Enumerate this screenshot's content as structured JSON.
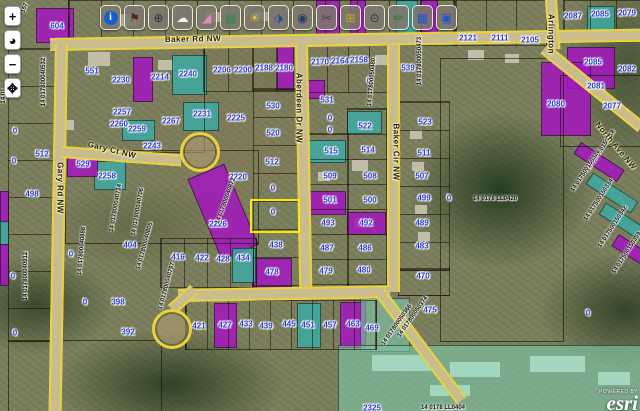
{
  "toolbar": {
    "buttons": [
      {
        "name": "info-icon",
        "glyph": "i",
        "color": "#ffffff",
        "circle": true
      },
      {
        "name": "flag-icon",
        "glyph": "⚑",
        "color": "#5a2424"
      },
      {
        "name": "zoom-in-icon",
        "glyph": "⊕",
        "color": "#333333"
      },
      {
        "name": "cloud-icon",
        "glyph": "☁",
        "color": "#f2f2f2"
      },
      {
        "name": "eraser-icon",
        "glyph": "◢",
        "color": "#e388c0"
      },
      {
        "name": "map-icon",
        "glyph": "▦",
        "color": "#2e8b57"
      },
      {
        "name": "bulb-icon",
        "glyph": "☀",
        "color": "#e8c32a"
      },
      {
        "name": "car-icon",
        "glyph": "⬗",
        "color": "#274b8f"
      },
      {
        "name": "camera-icon",
        "glyph": "◉",
        "color": "#223a66"
      },
      {
        "name": "scissors-icon",
        "glyph": "✂",
        "color": "#444444"
      },
      {
        "name": "network-icon",
        "glyph": "⊞",
        "color": "#c8a80f"
      },
      {
        "name": "search-icon",
        "glyph": "⊙",
        "color": "#333333"
      },
      {
        "name": "pencil-icon",
        "glyph": "✏",
        "color": "#2a7d2a"
      },
      {
        "name": "grid-icon",
        "glyph": "▦",
        "color": "#2255cc"
      },
      {
        "name": "save-icon",
        "glyph": "▣",
        "color": "#2255cc"
      }
    ]
  },
  "nav": [
    {
      "name": "zoom-in-button",
      "glyph": "+"
    },
    {
      "name": "globe-button",
      "glyph": "◕"
    },
    {
      "name": "zoom-out-button",
      "glyph": "−"
    },
    {
      "name": "pan-button",
      "glyph": "✥"
    }
  ],
  "attribution": {
    "powered": "POWERED BY",
    "brand": "esri"
  },
  "colors": {
    "purple": "rgba(163,22,190,.85)",
    "teal": "rgba(58,172,168,.8)",
    "teal_light": "rgba(125,200,170,.6)",
    "road_edge": "#e8d23f",
    "lot_label": "#2b3cd0",
    "selected": "#ffe800"
  },
  "labels": {
    "lots": [
      [
        "604",
        57,
        26
      ],
      [
        "2121",
        468,
        38
      ],
      [
        "2111",
        500,
        38
      ],
      [
        "2105",
        530,
        40
      ],
      [
        "2087",
        573,
        16
      ],
      [
        "2085",
        600,
        14
      ],
      [
        "2079",
        627,
        13
      ],
      [
        "551",
        92,
        71
      ],
      [
        "2230",
        121,
        80
      ],
      [
        "2214",
        160,
        77
      ],
      [
        "2240",
        188,
        74
      ],
      [
        "2206",
        222,
        70
      ],
      [
        "2200",
        243,
        70
      ],
      [
        "2188",
        264,
        68
      ],
      [
        "2180",
        284,
        68
      ],
      [
        "2170",
        320,
        62
      ],
      [
        "2164",
        340,
        61
      ],
      [
        "2158",
        359,
        60
      ],
      [
        "539",
        408,
        68
      ],
      [
        "531",
        327,
        100
      ],
      [
        "0",
        330,
        118
      ],
      [
        "0",
        330,
        130
      ],
      [
        "2257",
        122,
        112
      ],
      [
        "2260",
        119,
        124
      ],
      [
        "2259",
        137,
        129
      ],
      [
        "2267",
        171,
        121
      ],
      [
        "2231",
        202,
        114
      ],
      [
        "2225",
        236,
        118
      ],
      [
        "2243",
        152,
        146
      ],
      [
        "2220",
        238,
        177
      ],
      [
        "2226",
        218,
        224
      ],
      [
        "530",
        273,
        106
      ],
      [
        "520",
        273,
        133
      ],
      [
        "512",
        272,
        162
      ],
      [
        "0",
        273,
        188
      ],
      [
        "0",
        273,
        212
      ],
      [
        "438",
        276,
        245
      ],
      [
        "478",
        272,
        272
      ],
      [
        "515",
        331,
        151
      ],
      [
        "509",
        330,
        176
      ],
      [
        "501",
        330,
        200
      ],
      [
        "493",
        328,
        223
      ],
      [
        "487",
        327,
        248
      ],
      [
        "479",
        326,
        271
      ],
      [
        "522",
        365,
        126
      ],
      [
        "514",
        368,
        150
      ],
      [
        "508",
        370,
        176
      ],
      [
        "500",
        370,
        200
      ],
      [
        "492",
        366,
        223
      ],
      [
        "486",
        365,
        248
      ],
      [
        "480",
        364,
        270
      ],
      [
        "523",
        425,
        122
      ],
      [
        "511",
        424,
        153
      ],
      [
        "507",
        422,
        176
      ],
      [
        "499",
        424,
        198
      ],
      [
        "489",
        422,
        223
      ],
      [
        "483",
        422,
        246
      ],
      [
        "470",
        423,
        276
      ],
      [
        "475",
        430,
        310
      ],
      [
        "0",
        449,
        198
      ],
      [
        "0",
        369,
        81
      ],
      [
        "0",
        588,
        313
      ],
      [
        "512",
        42,
        154
      ],
      [
        "498",
        32,
        194
      ],
      [
        "0",
        15,
        131
      ],
      [
        "0",
        14,
        161
      ],
      [
        "0",
        13,
        276
      ],
      [
        "0",
        15,
        333
      ],
      [
        "529",
        83,
        164
      ],
      [
        "2258",
        107,
        176
      ],
      [
        "404",
        130,
        245
      ],
      [
        "0",
        71,
        254
      ],
      [
        "398",
        118,
        302
      ],
      [
        "0",
        85,
        302
      ],
      [
        "392",
        128,
        332
      ],
      [
        "416",
        178,
        257
      ],
      [
        "422",
        202,
        258
      ],
      [
        "428",
        223,
        259
      ],
      [
        "434",
        243,
        258
      ],
      [
        "421",
        199,
        326
      ],
      [
        "427",
        225,
        325
      ],
      [
        "433",
        246,
        324
      ],
      [
        "439",
        266,
        326
      ],
      [
        "445",
        289,
        324
      ],
      [
        "451",
        308,
        325
      ],
      [
        "457",
        330,
        325
      ],
      [
        "463",
        353,
        324
      ],
      [
        "469",
        372,
        328
      ],
      [
        "2085",
        593,
        62
      ],
      [
        "2082",
        627,
        69
      ],
      [
        "2081",
        596,
        86
      ],
      [
        "2077",
        612,
        106
      ],
      [
        "2080",
        556,
        104
      ],
      [
        "2325",
        372,
        408
      ]
    ],
    "ids": [
      [
        "14 017800040532",
        44,
        82,
        -90
      ],
      [
        "14 01",
        4,
        96,
        -90
      ],
      [
        "14 017800040912",
        26,
        276,
        -90
      ],
      [
        "14 017800040888",
        82,
        251,
        -85
      ],
      [
        "14 017800040714",
        116,
        208,
        -80
      ],
      [
        "14 017800040706",
        138,
        212,
        -80
      ],
      [
        "14 017800040805",
        145,
        246,
        -75
      ],
      [
        "14 017800040797",
        167,
        286,
        -75
      ],
      [
        "14 017800040872",
        226,
        201,
        -70
      ],
      [
        "14 017800050480",
        372,
        82,
        -85
      ],
      [
        "14 017800050473",
        420,
        61,
        -90
      ],
      [
        "14 0178  LL0420",
        495,
        199,
        0
      ],
      [
        "14 017800050374",
        413,
        317,
        -55
      ],
      [
        "14 017800050366",
        397,
        325,
        -55
      ],
      [
        "14 017500150318",
        601,
        151,
        -57
      ],
      [
        "14 017500150326",
        586,
        171,
        -57
      ],
      [
        "14 017500150334",
        599,
        200,
        -57
      ],
      [
        "14 017500150342",
        613,
        227,
        -57
      ],
      [
        "14 017500150359",
        627,
        253,
        -57
      ],
      [
        "14 0178  LL0404",
        443,
        408,
        0
      ],
      [
        "157",
        25,
        8,
        -70
      ]
    ],
    "streets": [
      [
        "Baker Rd NW",
        193,
        39,
        -1
      ],
      [
        "Gary Rd NW",
        60,
        188,
        90
      ],
      [
        "Gary Ct NW",
        112,
        150,
        14
      ],
      [
        "Aberdeen Dr NW",
        299,
        108,
        90
      ],
      [
        "Baker Cir NW",
        396,
        152,
        90
      ],
      [
        "Arlington",
        551,
        34,
        90
      ],
      [
        "North Ave NW",
        616,
        146,
        50
      ]
    ]
  },
  "geometry": {
    "roads": [
      {
        "x": 50,
        "y": 38,
        "w": 592,
        "h": 9,
        "rot": -0.9,
        "dir": "h"
      },
      {
        "x": 55,
        "y": 44,
        "w": 9,
        "h": 367,
        "rot": 1,
        "dir": "v"
      },
      {
        "x": 295,
        "y": 45,
        "w": 9,
        "h": 252,
        "rot": -1,
        "dir": "v"
      },
      {
        "x": 387,
        "y": 45,
        "w": 9,
        "h": 247,
        "rot": 0,
        "dir": "v"
      },
      {
        "x": 178,
        "y": 289,
        "w": 212,
        "h": 9,
        "rot": -1,
        "dir": "h"
      },
      {
        "x": 62,
        "y": 146,
        "w": 120,
        "h": 8,
        "rot": 4,
        "dir": "h"
      },
      {
        "x": 545,
        "y": 0,
        "w": 8,
        "h": 50,
        "rot": -4,
        "dir": "v"
      },
      {
        "x": 548,
        "y": 44,
        "w": 125,
        "h": 8,
        "rot": 39,
        "dir": "h"
      },
      {
        "x": 385,
        "y": 289,
        "w": 135,
        "h": 8,
        "rot": 53,
        "dir": "h"
      },
      {
        "x": 168,
        "y": 305,
        "w": 30,
        "h": 8,
        "rot": -42,
        "dir": "h"
      }
    ],
    "bulbs": [
      {
        "cx": 197,
        "cy": 149,
        "r": 17
      },
      {
        "cx": 169,
        "cy": 326,
        "r": 17
      }
    ],
    "selected": {
      "x": 250,
      "y": 199,
      "w": 46,
      "h": 30
    },
    "parcels": [
      {
        "x": 36,
        "y": 8,
        "w": 36,
        "h": 33,
        "f": "purple"
      },
      {
        "x": 316,
        "y": 0,
        "w": 22,
        "h": 40,
        "f": "purple"
      },
      {
        "x": 350,
        "y": 0,
        "w": 14,
        "h": 40,
        "f": "purple"
      },
      {
        "x": 396,
        "y": 0,
        "w": 20,
        "h": 34,
        "f": "teal"
      },
      {
        "x": 420,
        "y": 0,
        "w": 16,
        "h": 31,
        "f": "purple"
      },
      {
        "x": 133,
        "y": 57,
        "w": 18,
        "h": 43,
        "f": "purple"
      },
      {
        "x": 172,
        "y": 55,
        "w": 33,
        "h": 38,
        "f": "teal"
      },
      {
        "x": 183,
        "y": 102,
        "w": 34,
        "h": 27,
        "f": "teal"
      },
      {
        "x": 122,
        "y": 120,
        "w": 31,
        "h": 19,
        "f": "teal"
      },
      {
        "x": 94,
        "y": 161,
        "w": 30,
        "h": 27,
        "f": "teal"
      },
      {
        "x": 67,
        "y": 150,
        "w": 29,
        "h": 25,
        "f": "purple"
      },
      {
        "x": 277,
        "y": 42,
        "w": 15,
        "h": 46,
        "f": "purple"
      },
      {
        "x": 301,
        "y": 80,
        "w": 22,
        "h": 17,
        "f": "purple"
      },
      {
        "x": 347,
        "y": 111,
        "w": 33,
        "h": 21,
        "f": "teal"
      },
      {
        "x": 306,
        "y": 140,
        "w": 38,
        "h": 21,
        "f": "teal"
      },
      {
        "x": 307,
        "y": 191,
        "w": 37,
        "h": 22,
        "f": "purple"
      },
      {
        "x": 347,
        "y": 212,
        "w": 37,
        "h": 21,
        "f": "purple"
      },
      {
        "x": 252,
        "y": 258,
        "w": 38,
        "h": 27,
        "f": "purple"
      },
      {
        "x": 203,
        "y": 168,
        "w": 38,
        "h": 86,
        "f": "purple",
        "rot": -23
      },
      {
        "x": 232,
        "y": 248,
        "w": 22,
        "h": 33,
        "f": "teal"
      },
      {
        "x": 214,
        "y": 303,
        "w": 21,
        "h": 43,
        "f": "purple"
      },
      {
        "x": 297,
        "y": 303,
        "w": 22,
        "h": 43,
        "f": "teal"
      },
      {
        "x": 340,
        "y": 302,
        "w": 24,
        "h": 44,
        "f": "purple"
      },
      {
        "x": 360,
        "y": 298,
        "w": 48,
        "h": 52,
        "f": "teal_light"
      },
      {
        "x": 338,
        "y": 345,
        "w": 302,
        "h": 66,
        "f": "teal_light"
      },
      {
        "x": 567,
        "y": 47,
        "w": 46,
        "h": 40,
        "f": "purple"
      },
      {
        "x": 541,
        "y": 62,
        "w": 48,
        "h": 72,
        "f": "purple"
      },
      {
        "x": 587,
        "y": 6,
        "w": 26,
        "h": 30,
        "f": "teal"
      },
      {
        "x": 0,
        "y": 191,
        "w": 7,
        "h": 30,
        "f": "purple"
      },
      {
        "x": 0,
        "y": 221,
        "w": 7,
        "h": 23,
        "f": "teal"
      },
      {
        "x": 0,
        "y": 244,
        "w": 7,
        "h": 40,
        "f": "purple"
      },
      {
        "x": 592,
        "y": 136,
        "w": 12,
        "h": 50,
        "f": "purple",
        "rot": -57
      },
      {
        "x": 605,
        "y": 166,
        "w": 12,
        "h": 52,
        "f": "teal",
        "rot": -57
      },
      {
        "x": 618,
        "y": 196,
        "w": 12,
        "h": 52,
        "f": "teal",
        "rot": -57
      },
      {
        "x": 630,
        "y": 228,
        "w": 12,
        "h": 50,
        "f": "purple",
        "rot": -57
      }
    ],
    "grids": [
      {
        "x": 253,
        "y": 88,
        "w": 45,
        "h": 200,
        "dir": "rows",
        "step": 28
      },
      {
        "x": 303,
        "y": 133,
        "w": 44,
        "h": 153,
        "dir": "rows",
        "step": 25
      },
      {
        "x": 347,
        "y": 108,
        "w": 38,
        "h": 180,
        "dir": "rows",
        "step": 25
      },
      {
        "x": 398,
        "y": 101,
        "w": 50,
        "h": 168,
        "dir": "rows",
        "step": 28
      },
      {
        "x": 398,
        "y": 268,
        "w": 50,
        "h": 26,
        "dir": "rows",
        "step": 26
      },
      {
        "x": 160,
        "y": 238,
        "w": 95,
        "h": 48,
        "dir": "cols",
        "step": 23
      },
      {
        "x": 185,
        "y": 300,
        "w": 190,
        "h": 48,
        "dir": "cols",
        "step": 21
      },
      {
        "x": 203,
        "y": 45,
        "w": 95,
        "h": 45,
        "dir": "cols",
        "step": 24
      },
      {
        "x": 455,
        "y": 0,
        "w": 90,
        "h": 44,
        "dir": "cols",
        "step": 30
      },
      {
        "x": 8,
        "y": 48,
        "w": 48,
        "h": 292,
        "dir": "rows",
        "step": 37
      },
      {
        "x": 305,
        "y": 45,
        "w": 83,
        "h": 46,
        "dir": "cols",
        "step": 21
      },
      {
        "x": 563,
        "y": 0,
        "w": 77,
        "h": 30,
        "dir": "cols",
        "step": 26
      },
      {
        "x": 68,
        "y": 0,
        "w": 385,
        "h": 44,
        "dir": "cols",
        "step": 32
      }
    ],
    "outlines": [
      {
        "x": 65,
        "y": 45,
        "w": 138,
        "h": 106
      },
      {
        "x": 65,
        "y": 150,
        "w": 192,
        "h": 92
      },
      {
        "x": 440,
        "y": 58,
        "w": 122,
        "h": 282
      },
      {
        "x": 560,
        "y": 75,
        "w": 80,
        "h": 70
      },
      {
        "x": 8,
        "y": 340,
        "w": 152,
        "h": 71
      },
      {
        "x": 253,
        "y": 45,
        "w": 45,
        "h": 44
      }
    ],
    "buildings": [
      {
        "x": 88,
        "y": 52,
        "w": 22,
        "h": 14
      },
      {
        "x": 158,
        "y": 60,
        "w": 16,
        "h": 10
      },
      {
        "x": 375,
        "y": 55,
        "w": 14,
        "h": 10
      },
      {
        "x": 468,
        "y": 50,
        "w": 16,
        "h": 10
      },
      {
        "x": 505,
        "y": 54,
        "w": 14,
        "h": 9
      },
      {
        "x": 118,
        "y": 14,
        "w": 18,
        "h": 12
      },
      {
        "x": 205,
        "y": 12,
        "w": 16,
        "h": 10
      },
      {
        "x": 255,
        "y": 12,
        "w": 14,
        "h": 9
      },
      {
        "x": 60,
        "y": 120,
        "w": 14,
        "h": 10
      },
      {
        "x": 352,
        "y": 160,
        "w": 16,
        "h": 11
      },
      {
        "x": 318,
        "y": 172,
        "w": 12,
        "h": 9
      },
      {
        "x": 355,
        "y": 218,
        "w": 14,
        "h": 10
      },
      {
        "x": 410,
        "y": 130,
        "w": 12,
        "h": 9
      },
      {
        "x": 412,
        "y": 162,
        "w": 12,
        "h": 9
      },
      {
        "x": 415,
        "y": 205,
        "w": 12,
        "h": 9
      },
      {
        "x": 418,
        "y": 232,
        "w": 12,
        "h": 9
      },
      {
        "x": 372,
        "y": 355,
        "w": 60,
        "h": 16,
        "lt": true
      },
      {
        "x": 450,
        "y": 362,
        "w": 50,
        "h": 15,
        "lt": true
      },
      {
        "x": 530,
        "y": 356,
        "w": 55,
        "h": 16,
        "lt": true
      },
      {
        "x": 598,
        "y": 372,
        "w": 32,
        "h": 13,
        "lt": true
      },
      {
        "x": 430,
        "y": 385,
        "w": 40,
        "h": 11,
        "lt": true
      }
    ]
  }
}
